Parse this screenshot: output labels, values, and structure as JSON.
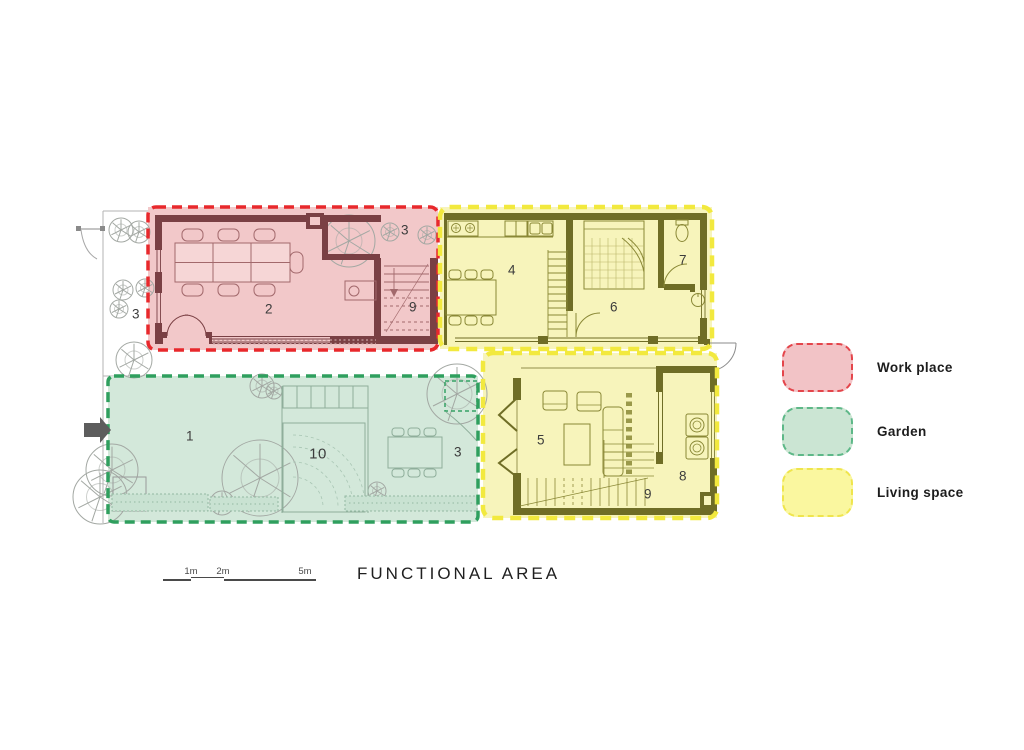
{
  "title": "FUNCTIONAL AREA",
  "legend": {
    "items": [
      {
        "label": "Work place",
        "fill": "#f2c3c6",
        "border": "#e4454b"
      },
      {
        "label": "Garden",
        "fill": "#cbe5d3",
        "border": "#5eb888"
      },
      {
        "label": "Living space",
        "fill": "#faf79f",
        "border": "#efe54d"
      }
    ]
  },
  "scale": {
    "labels": [
      "1m",
      "2m",
      "5m"
    ]
  },
  "colors": {
    "work_place_fill": "#f2c8c9",
    "work_place_border": "#e8282c",
    "work_place_wall": "#7a4044",
    "garden_fill": "#d3e8da",
    "garden_border": "#2f9f5e",
    "living_space_fill": "#f7f4bb",
    "living_space_border": "#f2e93e",
    "living_space_wall": "#6f6d26"
  },
  "room_labels": [
    {
      "area": "side-yard",
      "label": "3"
    },
    {
      "area": "office",
      "label": "2"
    },
    {
      "area": "trees-top",
      "label": "3"
    },
    {
      "area": "stairs-upper",
      "label": "9"
    },
    {
      "area": "kitchen-dining",
      "label": "4"
    },
    {
      "area": "bedroom",
      "label": "6"
    },
    {
      "area": "bathroom",
      "label": "7"
    },
    {
      "area": "living-room",
      "label": "5"
    },
    {
      "area": "laundry",
      "label": "8"
    },
    {
      "area": "stairs-lower",
      "label": "9"
    },
    {
      "area": "garden",
      "label": "1"
    },
    {
      "area": "deck",
      "label": "10"
    },
    {
      "area": "terrace",
      "label": "3"
    }
  ]
}
